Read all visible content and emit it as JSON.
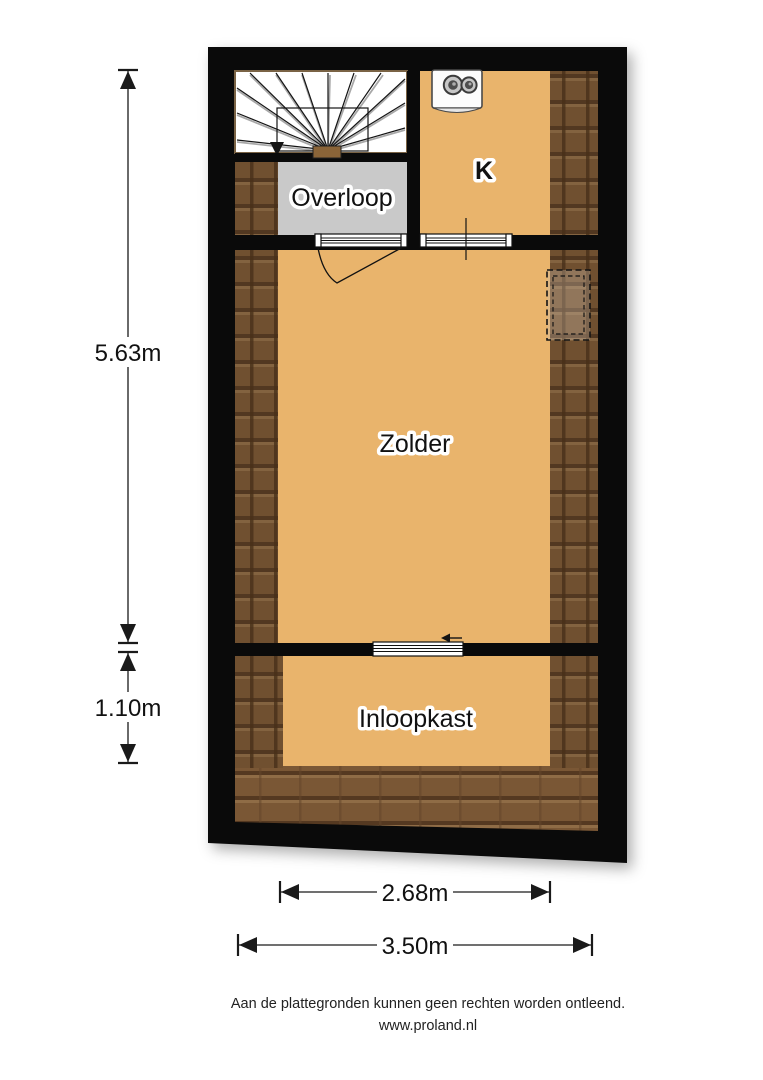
{
  "rooms": {
    "overloop": "Overloop",
    "k": "K",
    "zolder": "Zolder",
    "inloopkast": "Inloopkast"
  },
  "dimensions": {
    "height_main": "5.63m",
    "height_closet": "1.10m",
    "width_inner": "2.68m",
    "width_outer": "3.50m"
  },
  "footer": {
    "disclaimer": "Aan de plattegronden kunnen geen rechten worden ontleend.",
    "website": "www.proland.nl"
  },
  "colors": {
    "floor": "#e9b46c",
    "roof_base": "#7a5735",
    "roof_dark": "#553921",
    "roof_light": "#8f6c46",
    "landing_gray": "#c9c9c9",
    "wall_black": "#0a0a0a"
  },
  "icons": {
    "boiler": "central-heating-boiler",
    "stairs_arrow": "stairs-down-direction-arrow",
    "sliding_door_arrow": "sliding-door-direction-left",
    "roof_window": "dashed-roof-window"
  }
}
